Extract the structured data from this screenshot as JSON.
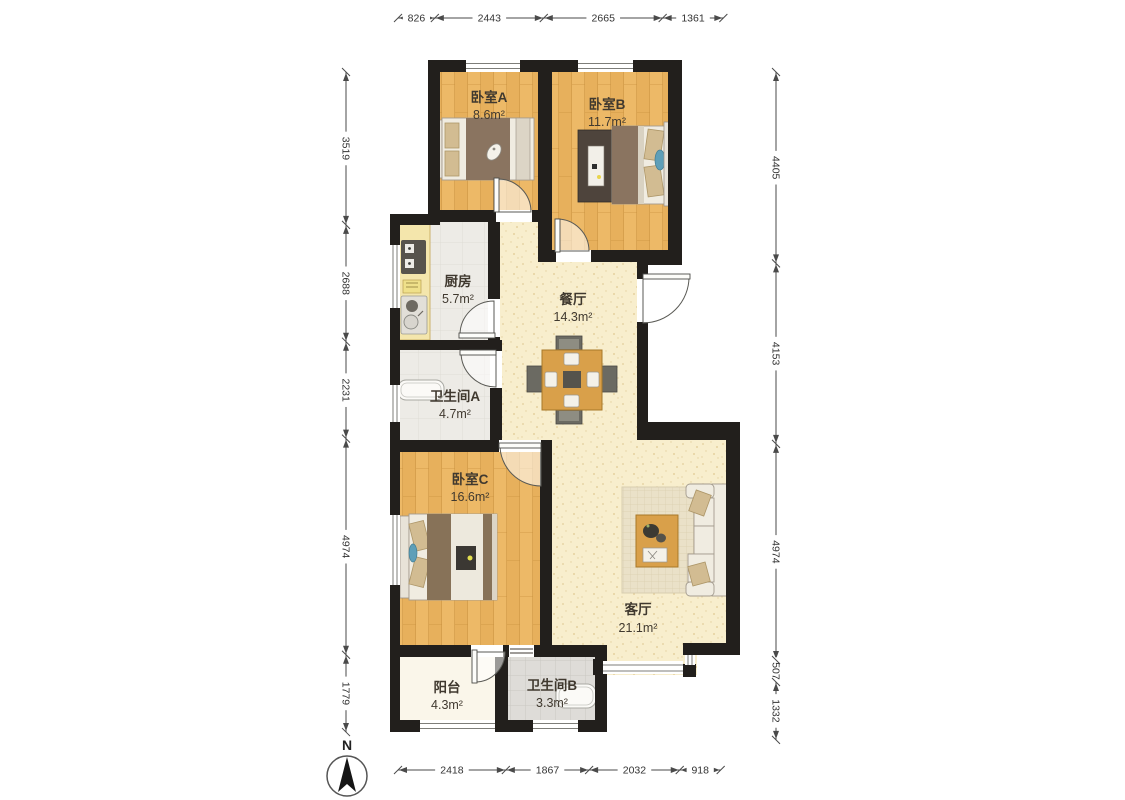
{
  "plan_title": "三室两厅户型图",
  "rooms": {
    "bedroomA": {
      "name": "卧室A",
      "area": "8.6m²"
    },
    "bedroomB": {
      "name": "卧室B",
      "area": "11.7m²"
    },
    "kitchen": {
      "name": "厨房",
      "area": "5.7m²"
    },
    "dining": {
      "name": "餐厅",
      "area": "14.3m²"
    },
    "bathroomA": {
      "name": "卫生间A",
      "area": "4.7m²"
    },
    "bedroomC": {
      "name": "卧室C",
      "area": "16.6m²"
    },
    "living": {
      "name": "客厅",
      "area": "21.1m²"
    },
    "balcony": {
      "name": "阳台",
      "area": "4.3m²"
    },
    "bathroomB": {
      "name": "卫生间B",
      "area": "3.3m²"
    }
  },
  "dimensions": {
    "top": [
      826,
      2443,
      2665,
      1361
    ],
    "bottom": [
      2418,
      1867,
      2032,
      918
    ],
    "left": [
      3519,
      2688,
      2231,
      4974,
      1779
    ],
    "right": [
      4405,
      4153,
      4974,
      507,
      1332
    ]
  },
  "compass": {
    "label": "N"
  },
  "colors": {
    "wall": "#221f1c",
    "wood_floor": "#edb967",
    "cream_floor": "#f8eecd",
    "tile_floor": "#dedcd8",
    "kitchen_floor": "#edebe6",
    "balcony_floor": "#faf6ea",
    "furniture_wood": "#d9a04a",
    "blanket_brown": "#8a7460",
    "accent_teal": "#5e9fb8",
    "dimension_line": "#4a4a4a"
  }
}
